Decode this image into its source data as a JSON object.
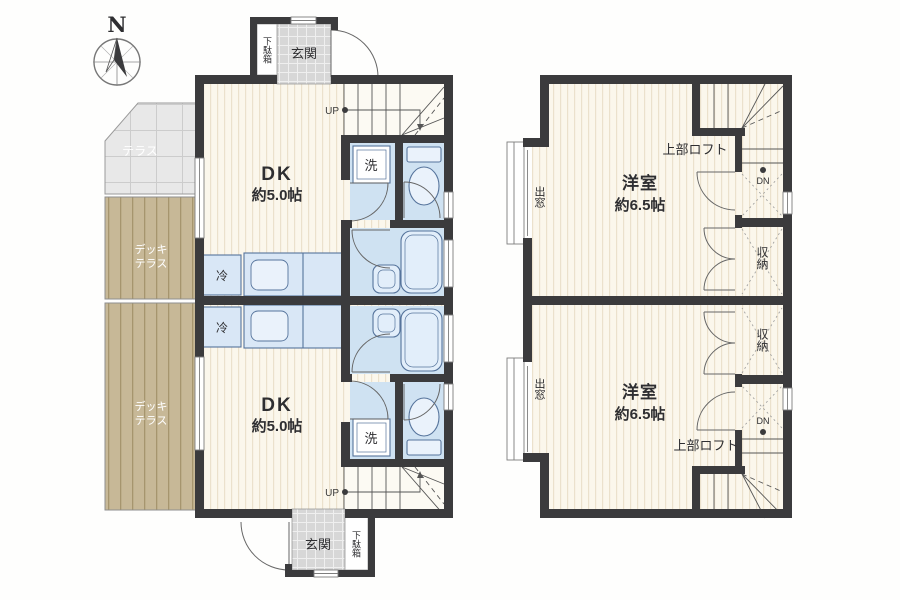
{
  "compass": {
    "north": "N"
  },
  "floor1": {
    "unit_a": {
      "entrance": "玄関",
      "shoe_cabinet": "下駄箱",
      "room_type": "DK",
      "room_size": "約5.0帖",
      "washer": "洗",
      "fridge": "冷",
      "stairs": "UP"
    },
    "unit_b": {
      "entrance": "玄関",
      "shoe_cabinet": "下駄箱",
      "room_type": "DK",
      "room_size": "約5.0帖",
      "washer": "洗",
      "fridge": "冷",
      "stairs": "UP"
    },
    "terrace": {
      "label": "テラス"
    },
    "deck_terrace_a": {
      "line1": "デッキ",
      "line2": "テラス"
    },
    "deck_terrace_b": {
      "line1": "デッキ",
      "line2": "テラス"
    }
  },
  "floor2": {
    "unit_a": {
      "bay_window": "出窓",
      "room_type": "洋室",
      "room_size": "約6.5帖",
      "loft": "上部ロフト",
      "closet": "収納",
      "stairs": "DN"
    },
    "unit_b": {
      "bay_window": "出窓",
      "room_type": "洋室",
      "room_size": "約6.5帖",
      "loft": "上部ロフト",
      "closet": "収納",
      "stairs": "DN"
    }
  },
  "colors": {
    "wall": "#3b3b3d",
    "sanitary": "#cfe2f2",
    "deck": "#c7b897",
    "fixture_stroke": "#56749c",
    "floor_stripe": "#ebe1cc"
  }
}
